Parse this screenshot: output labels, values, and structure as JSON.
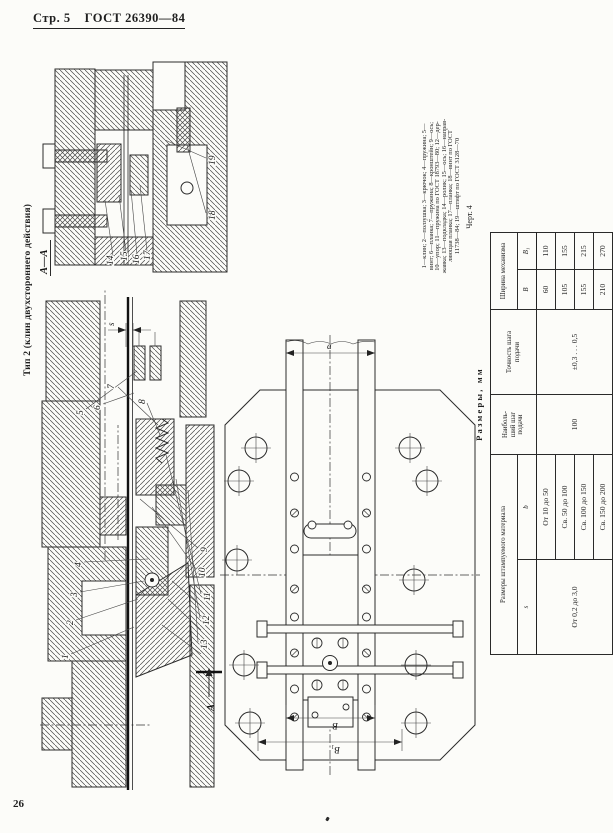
{
  "page": {
    "header_left": "Стр. 5",
    "header_doc": "ГОСТ 26390—84",
    "page_number": "26"
  },
  "drawing": {
    "title": "Тип 2 (клин двухстороннего действия)",
    "figure_caption": "Черт. 4",
    "section_view_label": "А—А",
    "cut_arrow_label": "А",
    "dims": {
      "strip_thickness": "s",
      "feed_step": "a",
      "width_b": "В",
      "width_b1": "В₁"
    },
    "callouts_main": [
      "1",
      "2",
      "3",
      "4",
      "5",
      "6",
      "7",
      "8",
      "9",
      "10",
      "11",
      "12",
      "13"
    ],
    "callouts_section": [
      "14",
      "15",
      "16",
      "17",
      "18",
      "19"
    ],
    "legend_lines": [
      "1—клин; 2—ползушка; 3—крючок; 4—пружина; 5—",
      "винт; 6—планка; 7—пружина; 8—кронштейн; 9—ось;",
      "10—упор; 11—пружина по ГОСТ 18793—80; 12—дер-",
      "жавка; 13—подкладка; 14—ролик; 15—ось; 16—направ-",
      "ляющая планка; 17—планка; 18—винт по ГОСТ",
      "11738—84; 19—штифт по ГОСТ 3128—70"
    ]
  },
  "table": {
    "title": "Размеры, мм",
    "headers": {
      "material_group": "Размеры штампуемого материала",
      "s": "s",
      "b": "b",
      "feed_step": "Наиболь-\nший шаг\nподачи",
      "accuracy": "Точность шага\nподачи",
      "width_group": "Ширина механизма",
      "B": "В",
      "B1": "В₁"
    },
    "s_value": "От 0,2 до 3,0",
    "feed_step_value": "100",
    "accuracy_value": "±0,3 . . . 0,5",
    "rows": [
      {
        "b": "От 10 до 50",
        "B": "60",
        "B1": "110"
      },
      {
        "b": "Св. 50 до 100",
        "B": "105",
        "B1": "155"
      },
      {
        "b": "Св. 100 до 150",
        "B": "155",
        "B1": "215"
      },
      {
        "b": "Св. 150 до 200",
        "B": "210",
        "B1": "270"
      }
    ]
  }
}
